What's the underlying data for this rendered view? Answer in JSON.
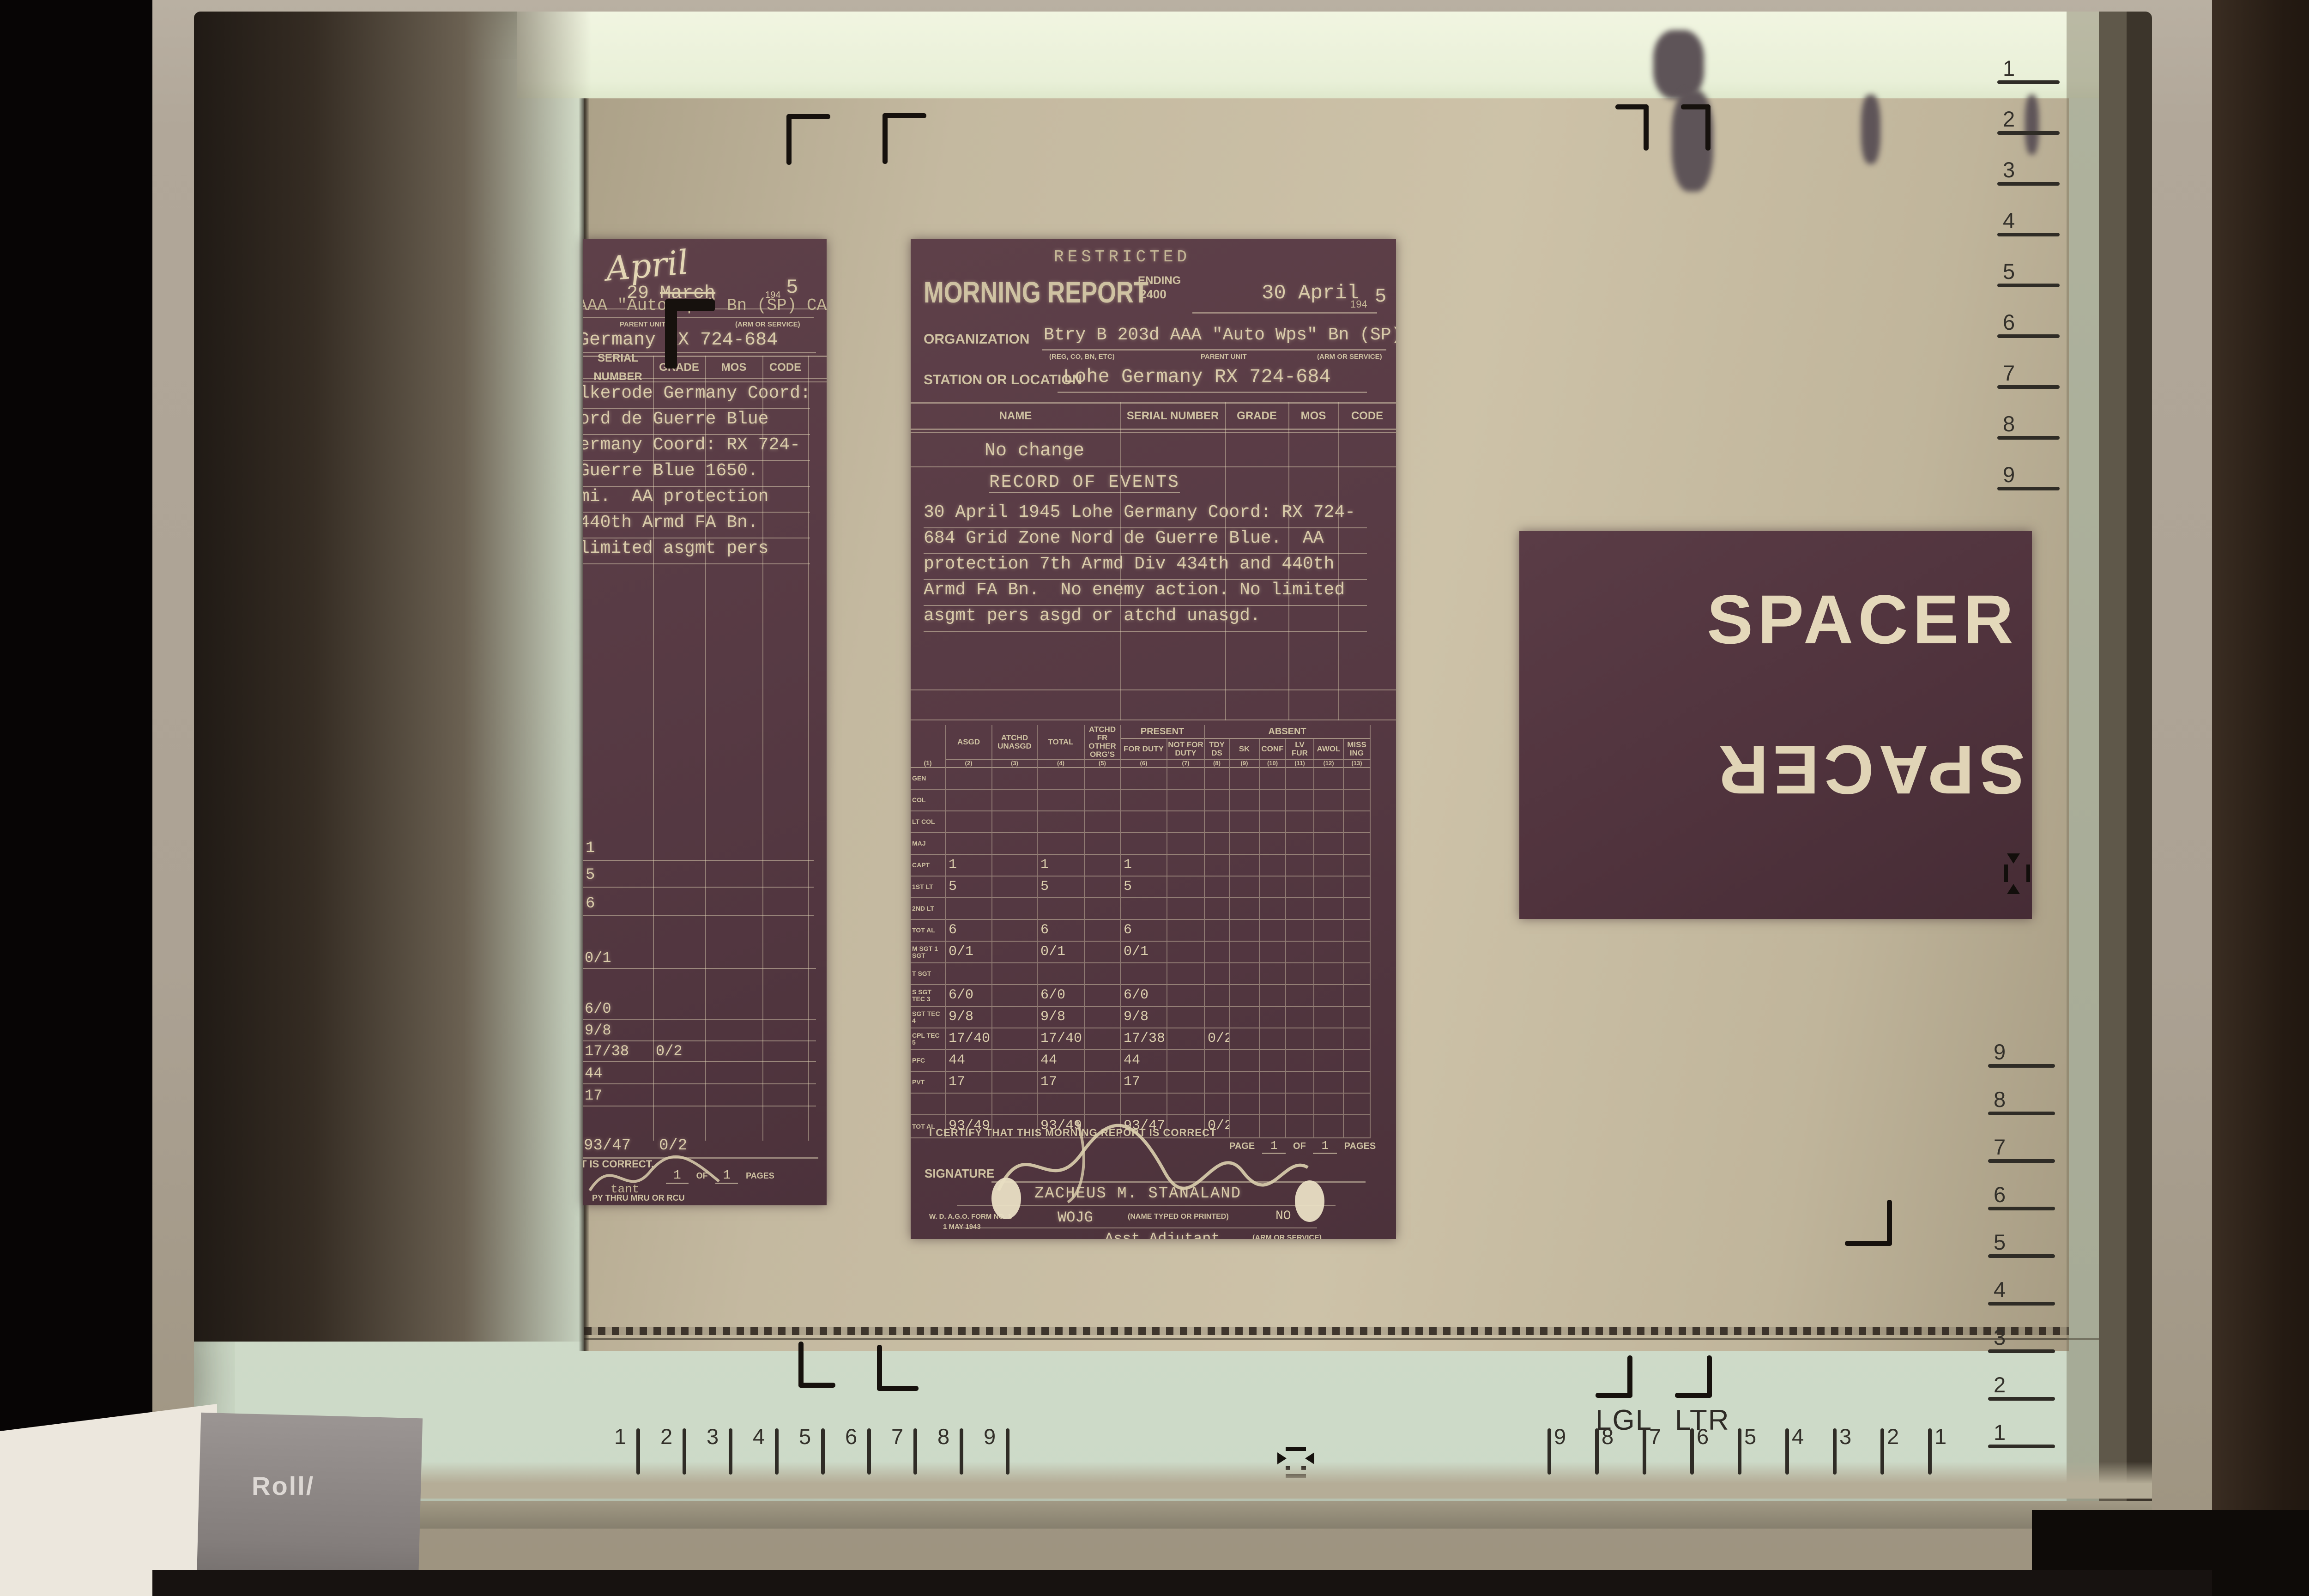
{
  "machine": {
    "roll_label": "Roll/"
  },
  "screen": {
    "legal_label": "LGL",
    "letter_label": "LTR"
  },
  "rulers": {
    "right_top": [
      "1",
      "2",
      "3",
      "4",
      "5",
      "6",
      "7",
      "8",
      "9"
    ],
    "right_bottom": [
      "9",
      "8",
      "7",
      "6",
      "5",
      "4",
      "3",
      "2",
      "1"
    ],
    "bottom_left": [
      "1",
      "2",
      "3",
      "4",
      "5",
      "6",
      "7",
      "8",
      "9"
    ],
    "bottom_right": [
      "9",
      "8",
      "7",
      "6",
      "5",
      "4",
      "3",
      "2",
      "1"
    ]
  },
  "spacer": {
    "label_top": "SPACER",
    "label_bottom": "SPACER"
  },
  "colors": {
    "film_tan": "#c4b9a0",
    "frame_maroon": "#573a44",
    "ink_cream": "#d9cba9",
    "screen_green": "#d2dfcc",
    "mark_black": "#16110d"
  },
  "morning_report": {
    "classification": "RESTRICTED",
    "title": "MORNING REPORT",
    "ending_label": "ENDING",
    "ending_value": "2400",
    "date_value": "30 April",
    "year_prefix": "194",
    "year_digit": "5",
    "organization_label": "ORGANIZATION",
    "organization_value": "Btry B 203d AAA \"Auto Wps\" Bn (SP) CAC",
    "org_sublabels": [
      "(REG, CO, BN, ETC)",
      "PARENT UNIT",
      "(ARM OR SERVICE)"
    ],
    "station_label": "STATION OR LOCATION",
    "station_value": "Lohe Germany RX 724-684",
    "roster_headers": [
      "NAME",
      "SERIAL NUMBER",
      "GRADE",
      "MOS",
      "CODE"
    ],
    "no_change": "No change",
    "record_of_events_label": "RECORD OF EVENTS",
    "event_lines": [
      "30 April 1945 Lohe Germany Coord: RX 724-",
      "684 Grid Zone Nord de Guerre Blue.  AA",
      "protection 7th Armd Div 434th and 440th",
      "Armd FA Bn.  No enemy action. No limited",
      "asgmt pers asgd or atchd unasgd."
    ],
    "strength_table": {
      "present_label": "PRESENT",
      "absent_label": "ABSENT",
      "rank_col_num": "(1)",
      "columns": [
        {
          "label": "ASGD",
          "num": "(2)"
        },
        {
          "label": "ATCHD UNASGD",
          "num": "(3)"
        },
        {
          "label": "TOTAL",
          "num": "(4)"
        },
        {
          "label": "ATCHD FR OTHER ORG'S",
          "num": "(5)"
        },
        {
          "label": "FOR DUTY",
          "num": "(6)"
        },
        {
          "label": "NOT FOR DUTY",
          "num": "(7)"
        },
        {
          "label": "TDY DS",
          "num": "(8)"
        },
        {
          "label": "SK",
          "num": "(9)"
        },
        {
          "label": "CONF",
          "num": "(10)"
        },
        {
          "label": "LV FUR",
          "num": "(11)"
        },
        {
          "label": "AWOL",
          "num": "(12)"
        },
        {
          "label": "MISS ING",
          "num": "(13)"
        }
      ],
      "rows": [
        {
          "rank": "GEN",
          "values": []
        },
        {
          "rank": "COL",
          "values": []
        },
        {
          "rank": "LT COL",
          "values": []
        },
        {
          "rank": "MAJ",
          "values": []
        },
        {
          "rank": "CAPT",
          "values": [
            "1",
            "",
            "1",
            "",
            "1"
          ]
        },
        {
          "rank": "1ST LT",
          "values": [
            "5",
            "",
            "5",
            "",
            "5"
          ]
        },
        {
          "rank": "2ND LT",
          "values": []
        },
        {
          "rank": "TOT AL",
          "values": [
            "6",
            "",
            "6",
            "",
            "6"
          ]
        },
        {
          "rank": "M SGT 1 SGT",
          "values": [
            "0/1",
            "",
            "0/1",
            "",
            "0/1"
          ]
        },
        {
          "rank": "T SGT",
          "values": []
        },
        {
          "rank": "S SGT TEC 3",
          "values": [
            "6/0",
            "",
            "6/0",
            "",
            "6/0"
          ]
        },
        {
          "rank": "SGT TEC 4",
          "values": [
            "9/8",
            "",
            "9/8",
            "",
            "9/8"
          ]
        },
        {
          "rank": "CPL TEC 5",
          "values": [
            "17/40",
            "",
            "17/40",
            "",
            "17/38",
            "",
            "0/2"
          ]
        },
        {
          "rank": "PFC",
          "values": [
            "44",
            "",
            "44",
            "",
            "44"
          ]
        },
        {
          "rank": "PVT",
          "values": [
            "17",
            "",
            "17",
            "",
            "17"
          ]
        },
        {
          "rank": "",
          "values": []
        }
      ],
      "total_row": {
        "rank": "TOT AL",
        "values": [
          "93/49",
          "",
          "93/49",
          "",
          "93/47",
          "",
          "0/2"
        ]
      }
    },
    "certify_line": "I CERTIFY THAT THIS MORNING REPORT IS CORRECT",
    "page_label": "PAGE",
    "page_num": "1",
    "of_label": "OF",
    "pages_num": "1",
    "pages_label": "PAGES",
    "signature_label": "SIGNATURE",
    "signed_name": "ZACHEUS M. STANALAND",
    "grade_value": "WOJG",
    "name_sublabel": "(NAME TYPED OR PRINTED)",
    "service_value": "NO",
    "title_value": "Asst Adjutant",
    "service_sublabel": "(ARM OR SERVICE)",
    "form_number": "W. D. A.G.O. FORM NO. 1",
    "form_date": "1 MAY 1943",
    "copy_note": "W. D. COPY THRU MRU OR RCU"
  },
  "left_report": {
    "handwritten_month": "April",
    "date_day": "29",
    "struck_month": "March",
    "year_prefix": "194",
    "year_digit": "5",
    "org_fragment": "AAA \"Auto Wps\" Bn (SP) CAC",
    "org_sublabels": [
      "PARENT UNIT",
      "(ARM OR SERVICE)"
    ],
    "station_fragment": "Germany RX 724-684",
    "roster_headers": [
      "SERIAL NUMBER",
      "GRADE",
      "MOS",
      "CODE"
    ],
    "event_lines": [
      "lkerode Germany Coord:",
      "ord de Guerre Blue",
      "ermany Coord: RX 724-",
      "Guerre Blue 1650.",
      "mi.  AA protection",
      "440th Armd FA Bn.",
      "limited asgmt pers"
    ],
    "officer_counts": [
      "1",
      "5",
      "6"
    ],
    "tally_rows": [
      [
        "0/1",
        ""
      ],
      [
        "6/0",
        ""
      ],
      [
        "9/8",
        ""
      ],
      [
        "17/38",
        "0/2"
      ],
      [
        "44",
        ""
      ],
      [
        "17",
        ""
      ]
    ],
    "total_row": [
      "93/47",
      "0/2"
    ],
    "certify_fragment": "T IS CORRECT.",
    "page_num": "1",
    "of_label": "OF",
    "pages_num": "1",
    "pages_label": "PAGES",
    "adjutant_fragment": "tant",
    "footer_fragment": "PY THRU MRU OR RCU"
  }
}
